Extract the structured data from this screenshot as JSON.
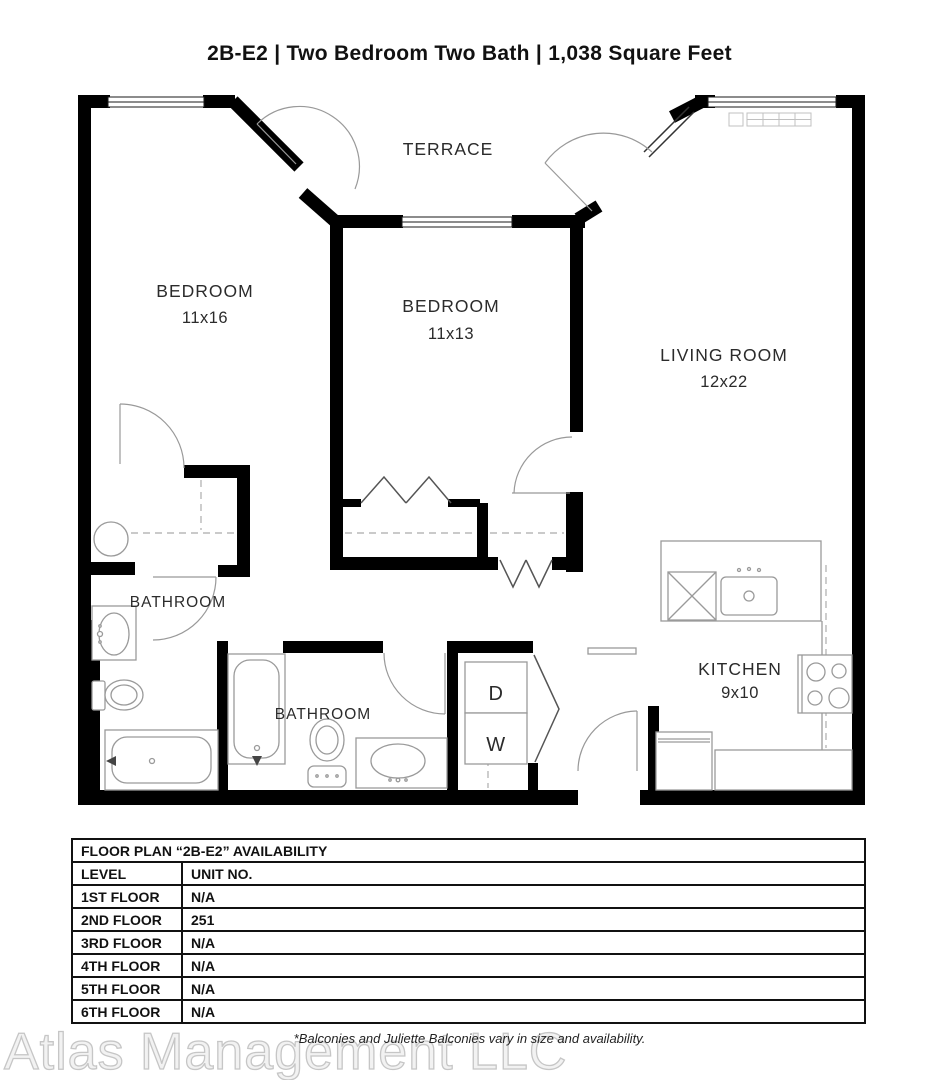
{
  "header": {
    "title": "2B-E2 | Two Bedroom Two Bath | 1,038 Square Feet"
  },
  "floor_plan": {
    "terrace_label": "TERRACE",
    "bedroom_1": {
      "label": "BEDROOM",
      "dimensions": "11x16"
    },
    "bedroom_2": {
      "label": "BEDROOM",
      "dimensions": "11x13"
    },
    "living_room": {
      "label": "LIVING ROOM",
      "dimensions": "12x22"
    },
    "kitchen": {
      "label": "KITCHEN",
      "dimensions": "9x10"
    },
    "bathroom_1_label": "BATHROOM",
    "bathroom_2_label": "BATHROOM",
    "dryer_label": "D",
    "washer_label": "W"
  },
  "availability_table": {
    "title": "FLOOR PLAN “2B-E2” AVAILABILITY",
    "columns": [
      "LEVEL",
      "UNIT NO."
    ],
    "rows": [
      {
        "level": "1ST FLOOR",
        "unit": "N/A"
      },
      {
        "level": "2ND FLOOR",
        "unit": "251"
      },
      {
        "level": "3RD FLOOR",
        "unit": "N/A"
      },
      {
        "level": "4TH FLOOR",
        "unit": "N/A"
      },
      {
        "level": "5TH FLOOR",
        "unit": "N/A"
      },
      {
        "level": "6TH FLOOR",
        "unit": "N/A"
      }
    ]
  },
  "footnote": "*Balconies and Juliette Balconies vary in size and availability.",
  "watermark": "Atlas Management LLC",
  "colors": {
    "wall": "#000000",
    "fixture_line": "#9a9a9a",
    "label_text": "#2b2b2b",
    "watermark_outline": "#c6c6c6"
  }
}
